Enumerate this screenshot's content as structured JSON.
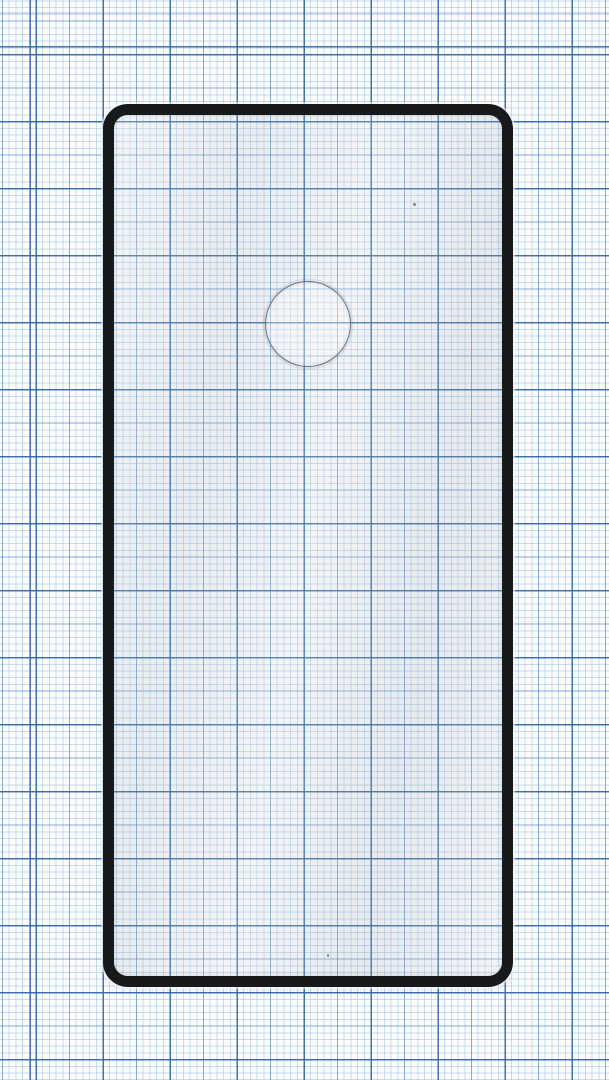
{
  "meta": {
    "type": "product-photo",
    "subject": "tempered glass screen protector with black frame lying on millimeter graph paper"
  },
  "paper": {
    "name": "millimeter-graph-paper",
    "paper_color": "#fcfdff",
    "fine_line_color": "#c3d9ee",
    "medium_line_color": "#7aa6d6",
    "heavy_line_color": "#3e76b5",
    "fine_spacing_px": 6.7,
    "medium_spacing_px": 33.5,
    "heavy_spacing_px": 67
  },
  "protector": {
    "name": "screen-protector-glass",
    "frame_color": "#17191b",
    "frame_border_px": 11,
    "corner_radius_px": 25,
    "outer_width_px": 410,
    "outer_height_px": 883,
    "glass_tint": "rgba(150,156,162,0.10)",
    "camera_cutout": {
      "shape": "circle",
      "center_x_px": 308,
      "center_y_px": 324,
      "radius_px": 43,
      "edge_color": "#48525c"
    }
  }
}
